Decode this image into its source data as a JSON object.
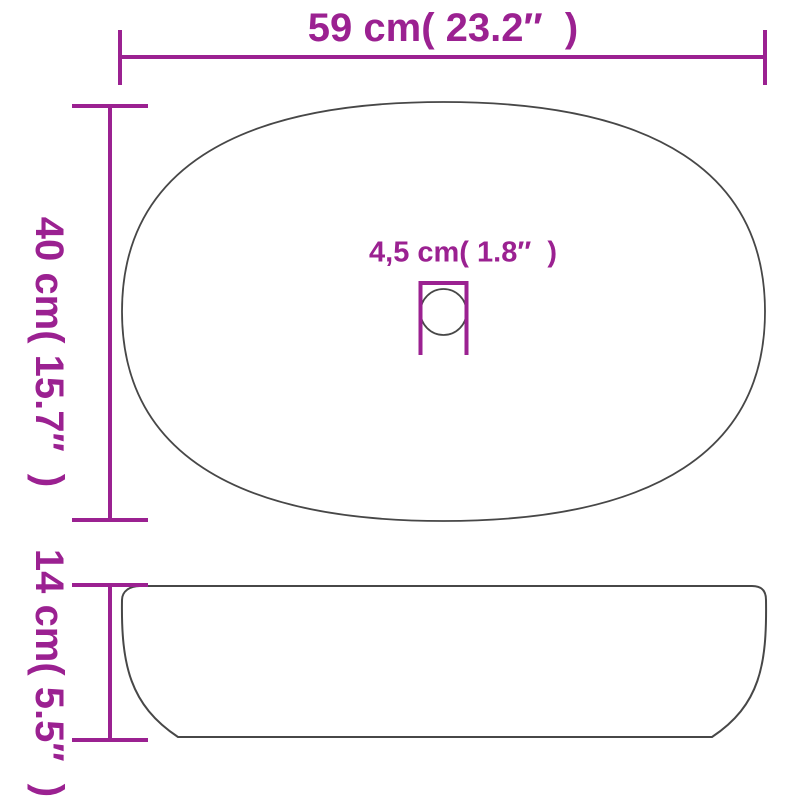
{
  "diagram": {
    "type": "product-dimension-drawing",
    "views": {
      "top_view": "oval-basin-top-view-with-drain-hole",
      "side_view": "basin-side-profile"
    }
  },
  "labels": {
    "width": "59 cm( 23.2″  )",
    "depth": "40 cm( 15.7″  )",
    "drain": "4,5 cm( 1.8″  )",
    "height": "14 cm( 5.5″  )"
  },
  "colors": {
    "dimension": "#9B2191",
    "outline": "#474747",
    "background": "#ffffff"
  }
}
